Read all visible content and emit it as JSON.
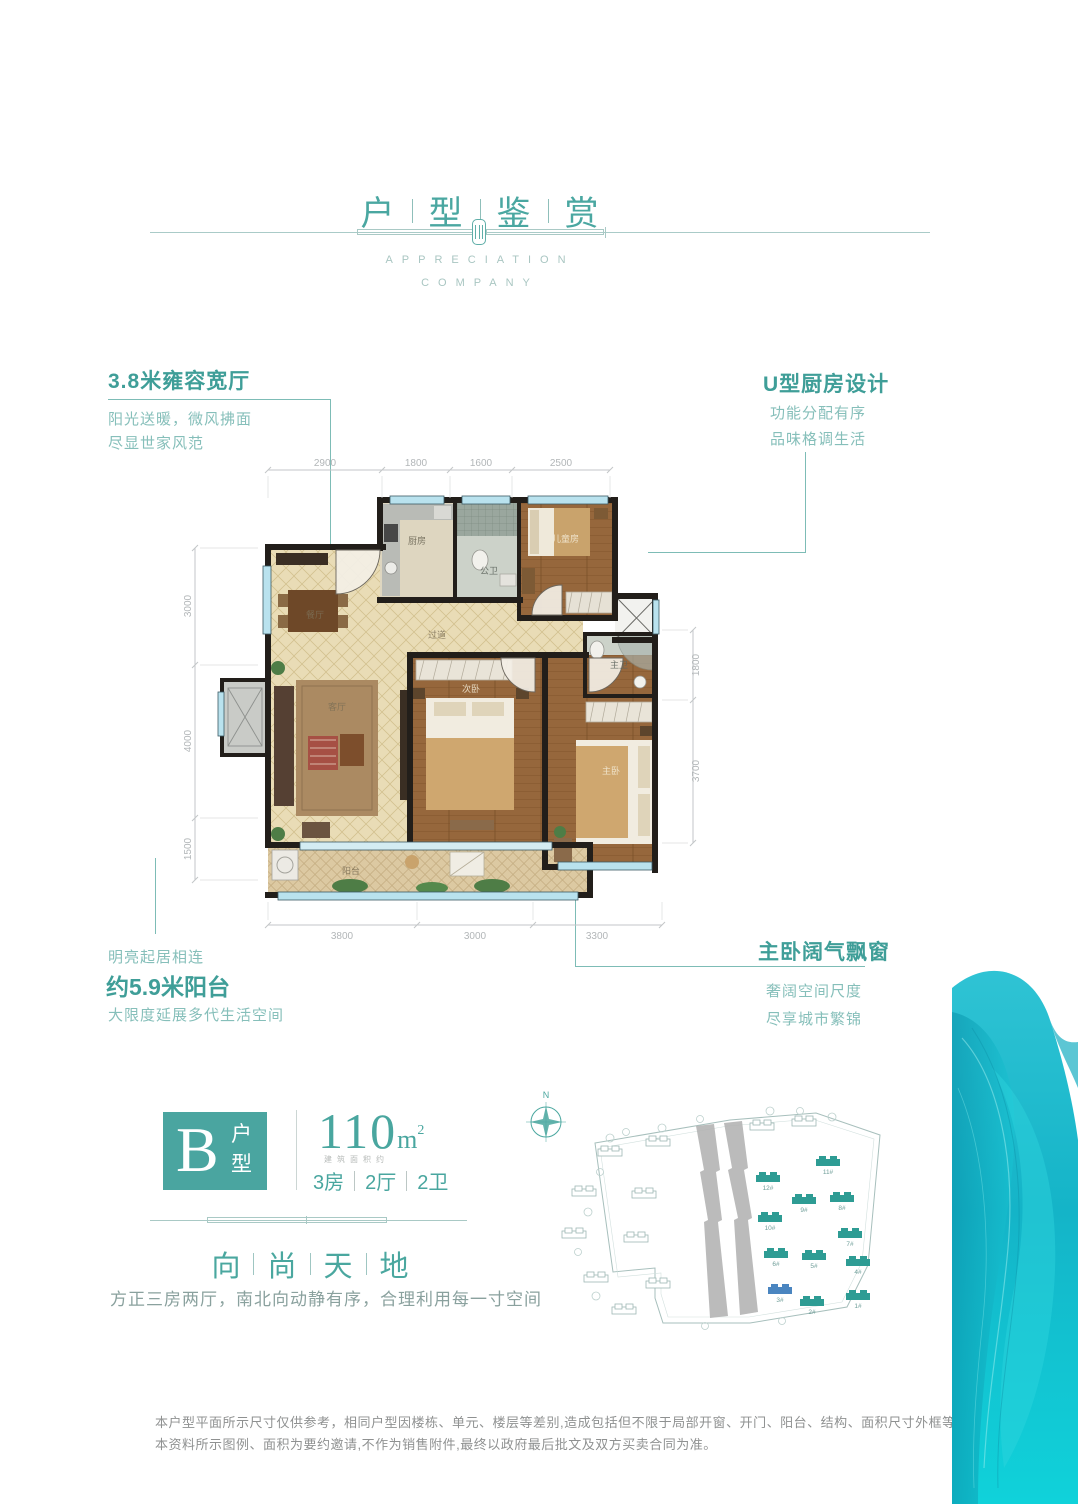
{
  "header": {
    "title_chars": [
      "户",
      "型",
      "鉴",
      "赏"
    ],
    "subtitle_top": "APPRECIATION",
    "subtitle_bottom": "COMPANY"
  },
  "callouts": {
    "top_left": {
      "title": "3.8米雍容宽厅",
      "line1": "阳光送暖，微风拂面",
      "line2": "尽显世家风范"
    },
    "top_right": {
      "title": "U型厨房设计",
      "line1": "功能分配有序",
      "line2": "品味格调生活"
    },
    "bottom_left": {
      "pre": "明亮起居相连",
      "title": "约5.9米阳台",
      "line1": "大限度延展多代生活空间"
    },
    "bottom_right": {
      "title": "主卧阔气飘窗",
      "line1": "奢阔空间尺度",
      "line2": "尽享城市繁锦"
    }
  },
  "floorplan": {
    "dims_top": [
      "2900",
      "1800",
      "1600",
      "2500"
    ],
    "dims_left": [
      "3000",
      "4000",
      "1500"
    ],
    "dims_right": [
      "1800",
      "3700"
    ],
    "dims_bottom": [
      "3800",
      "3000",
      "3300"
    ],
    "rooms": {
      "dining": "餐厅",
      "living": "客厅",
      "kitchen": "厨房",
      "bath": "公卫",
      "kids": "儿童房",
      "bedroom2": "次卧",
      "master": "主卧",
      "master_bath": "主卫",
      "corridor": "过道",
      "balcony": "阳台"
    }
  },
  "unit": {
    "letter": "B",
    "type_top": "户",
    "type_bottom": "型",
    "area": "110",
    "area_unit": "m",
    "area_sup": "2",
    "area_note": "建筑面积约",
    "spec1": "3房",
    "spec2": "2厅",
    "spec3": "2卫",
    "slogan_chars": [
      "向",
      "尚",
      "天",
      "地"
    ],
    "tagline": "方正三房两厅，南北向动静有序，合理利用每一寸空间"
  },
  "siteplan": {
    "north": "N",
    "buildings": [
      "12#",
      "11#",
      "10#",
      "9#",
      "8#",
      "7#",
      "6#",
      "5#",
      "4#",
      "3#",
      "2#",
      "1#"
    ]
  },
  "disclaimer": {
    "line1": "本户型平面所示尺寸仅供参考，相同户型因楼栋、单元、楼层等差别,造成包括但不限于局部开窗、开门、阳台、结构、面积尺寸外框等不同。",
    "line2": "本资料所示图例、面积为要约邀请,不作为销售附件,最终以政府最后批文及双方买卖合同为准。"
  },
  "colors": {
    "accent": "#45A49E",
    "accent_light": "#8CC4BF",
    "dim_gray": "#B7BBBD",
    "wall": "#221E1A",
    "wave": "#18BFCE"
  }
}
